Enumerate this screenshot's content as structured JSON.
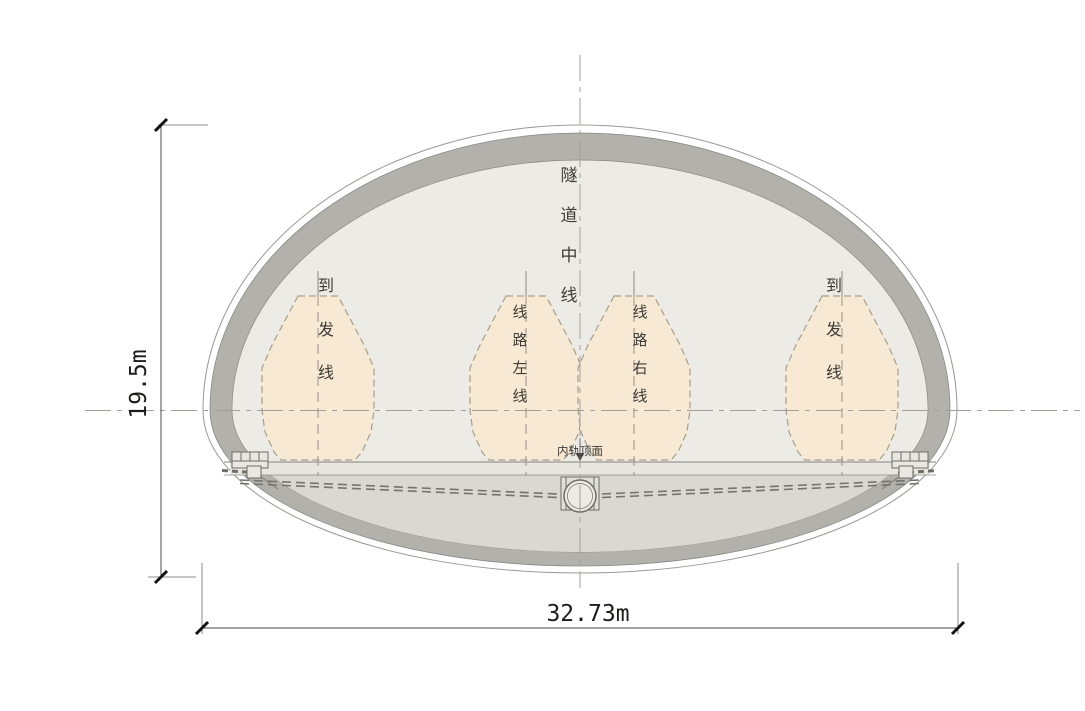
{
  "diagram": {
    "labels": {
      "tunnel_centerline": "隧道中线",
      "arrival_departure": "到发线",
      "line_left": "线路左线",
      "line_right": "线路右线",
      "rail_top_surface": "内轨顶面"
    },
    "dimensions": {
      "height": "19.5m",
      "width": "32.73m"
    },
    "colors": {
      "envelope_fill": "#f7e9d4",
      "interior_fill": "#edebe5",
      "lining_gray": "#b3b1ac",
      "invert_fill": "#dbd8d2",
      "strip_fill": "#e9e6e0",
      "outline_stroke": "#8f8d88",
      "envelope_stroke": "#a89e8d"
    }
  }
}
